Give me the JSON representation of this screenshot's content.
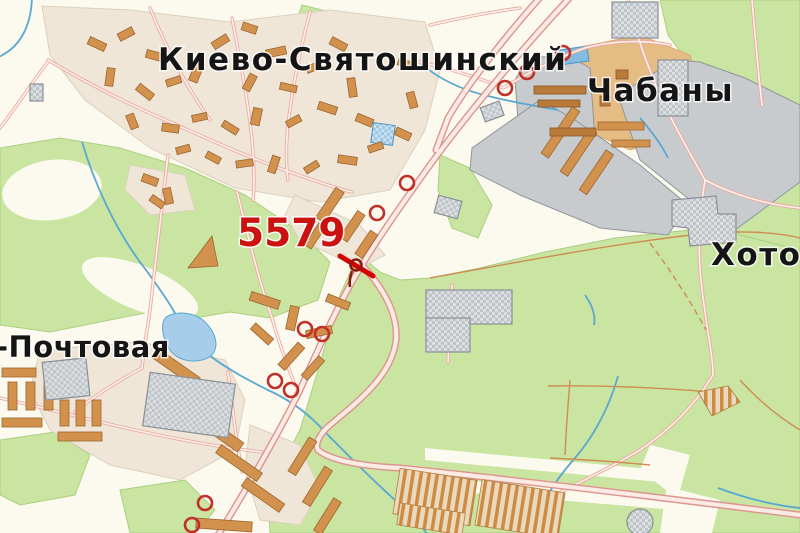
{
  "map": {
    "labels": {
      "district": "Киево-Святошинский",
      "settlement_ne": "Чабаны",
      "settlement_e": "Хотов",
      "settlement_sw": "-Почтовая",
      "route_number": "5579"
    },
    "colors": {
      "background": "#FCFAEE",
      "forest": "#C9E5A1",
      "built_up": "#EFE6D8",
      "industrial": "#C8CBCE",
      "building": "#D2914C",
      "road_casing": "#DF938D",
      "road_fill": "#FBEBE5",
      "water": "#5AA7D0",
      "marker_red": "#C03028",
      "route_red": "#CC1111",
      "label_black": "#151515"
    },
    "markers": {
      "poi_circles": [
        [
          563,
          53
        ],
        [
          527,
          72
        ],
        [
          505,
          88
        ],
        [
          407,
          183
        ],
        [
          377,
          213
        ],
        [
          305,
          329
        ],
        [
          322,
          334
        ],
        [
          275,
          381
        ],
        [
          291,
          390
        ],
        [
          205,
          503
        ],
        [
          192,
          525
        ]
      ],
      "crossing": {
        "x": 356,
        "y": 266
      }
    }
  }
}
